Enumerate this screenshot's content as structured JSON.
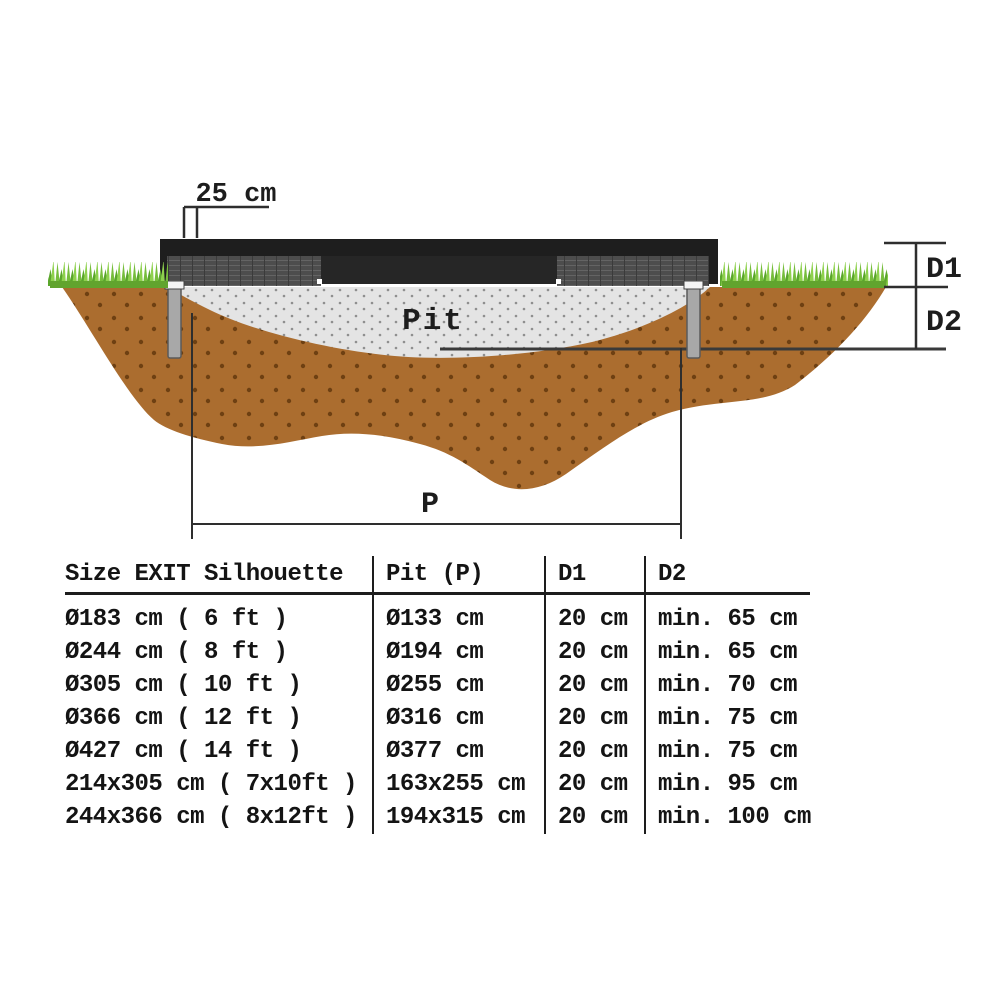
{
  "diagram": {
    "labels": {
      "offset": "25 cm",
      "pit": "Pit",
      "pit_width": "P",
      "depth1": "D1",
      "depth2": "D2"
    },
    "colors": {
      "soil": "#AB6D2F",
      "soil_dot": "#6E4012",
      "pit_fill": "#E4E4E4",
      "pit_dot": "#8F8F8F",
      "grass_bright": "#8ED14E",
      "grass_mid": "#76BD3C",
      "grass_dark": "#5AA62C",
      "frame_black": "#1E1E1E",
      "pad_gray": "#4D4D4D",
      "leg_gray": "#A8A8A8",
      "dimension_line": "#2E2E2E"
    }
  },
  "table": {
    "headers": [
      "Size EXIT  Silhouette",
      "Pit (P)",
      "D1",
      "D2"
    ],
    "rows": [
      {
        "size": "Ø183 cm ( 6 ft )",
        "pit": "Ø133 cm",
        "d1": "20 cm",
        "d2": "min. 65 cm"
      },
      {
        "size": "Ø244 cm ( 8 ft )",
        "pit": "Ø194 cm",
        "d1": "20 cm",
        "d2": "min. 65 cm"
      },
      {
        "size": "Ø305 cm ( 10 ft )",
        "pit": "Ø255 cm",
        "d1": "20 cm",
        "d2": "min. 70 cm"
      },
      {
        "size": "Ø366 cm ( 12 ft )",
        "pit": "Ø316 cm",
        "d1": "20 cm",
        "d2": "min. 75 cm"
      },
      {
        "size": "Ø427 cm ( 14 ft )",
        "pit": "Ø377 cm",
        "d1": "20 cm",
        "d2": "min. 75 cm"
      },
      {
        "size": "214x305 cm ( 7x10ft )",
        "pit": "163x255 cm",
        "d1": "20 cm",
        "d2": "min. 95 cm"
      },
      {
        "size": "244x366 cm ( 8x12ft )",
        "pit": "194x315 cm",
        "d1": "20 cm",
        "d2": "min. 100 cm"
      }
    ]
  }
}
